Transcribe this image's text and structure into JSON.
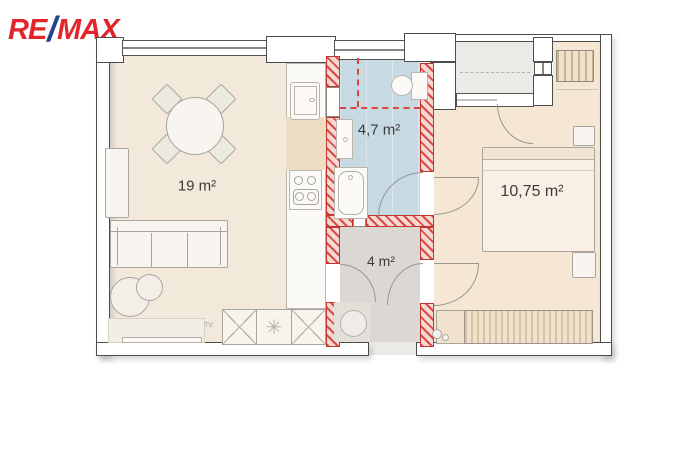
{
  "logo": {
    "re": "RE",
    "slash": "/",
    "max": "MAX"
  },
  "rooms": {
    "living": {
      "label": "19 m²",
      "fill": "#f2e9db"
    },
    "bathroom": {
      "label": "4,7 m²",
      "fill": "#c7dae3"
    },
    "hallway": {
      "label": "4 m²",
      "fill": "#dbd8d3"
    },
    "bedroom": {
      "label": "10,75 m²",
      "fill": "#f6e6d4"
    },
    "balcony": {
      "fill": "#eceae6"
    }
  },
  "annotations": {
    "tv": "TV",
    "wardrobe_star": "✳"
  },
  "colors": {
    "brand_red": "#e1252b",
    "brand_blue": "#24418e",
    "reconstruction_red": "#d6423b",
    "wall_outline": "#4c4c4a"
  }
}
